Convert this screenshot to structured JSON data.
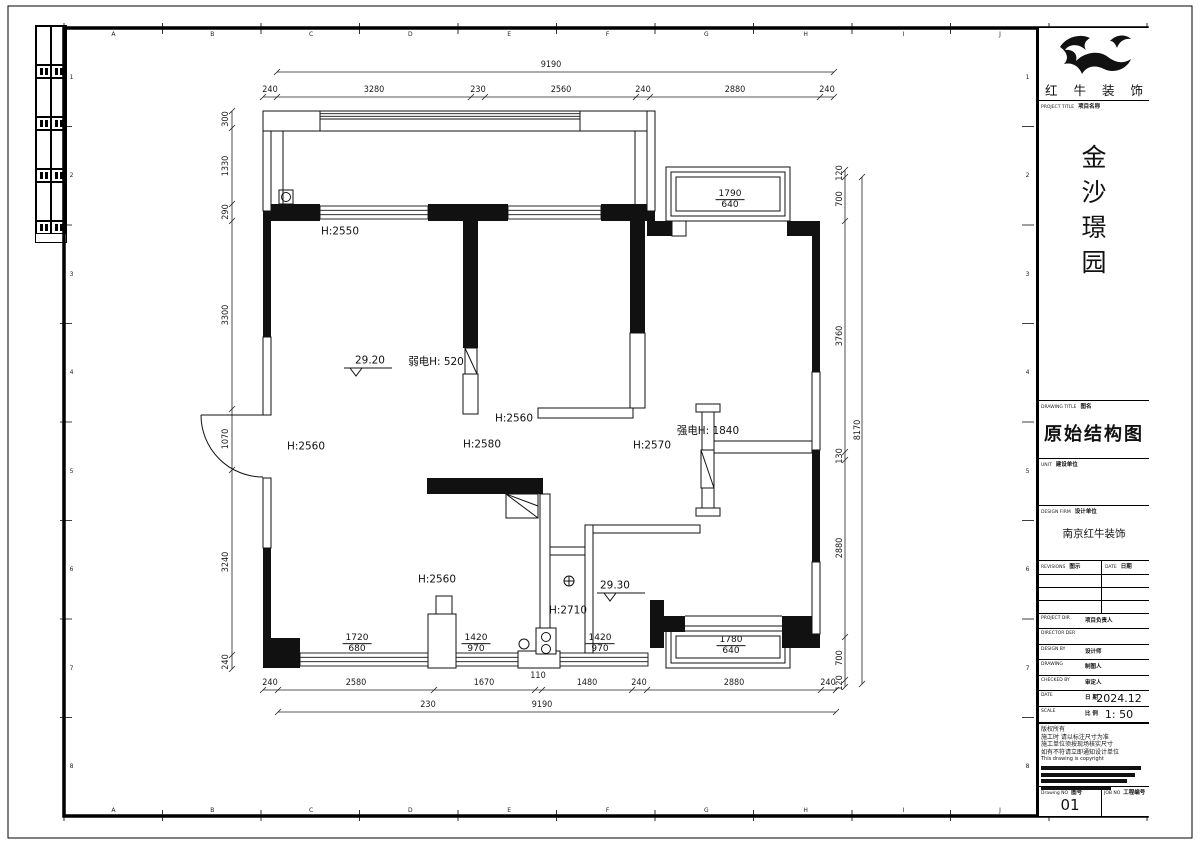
{
  "sheet": {
    "ruler_letters": [
      "A",
      "B",
      "C",
      "D",
      "E",
      "F",
      "G",
      "H",
      "I",
      "J",
      "K"
    ],
    "ruler_numbers_left": [
      "1",
      "2",
      "3",
      "4",
      "5",
      "6",
      "7",
      "8"
    ],
    "ruler_numbers_right": [
      "1",
      "2",
      "3",
      "4",
      "5",
      "6",
      "7",
      "8"
    ]
  },
  "title_block": {
    "brand_name": "红 牛 装 饰",
    "project_label_en": "PROJECT TITLE",
    "project_label_zh": "项目名称",
    "project_name": "金沙璟园",
    "project_name_chars": [
      "金",
      "沙",
      "璟",
      "园"
    ],
    "drawing_title_label_en": "DRAWING TITLE",
    "drawing_title_label_zh": "图名",
    "drawing_title": "原始结构图",
    "unit_label_en": "UNIT",
    "unit_label_zh": "建设单位",
    "design_firm_label_en": "DESIGN FIRM",
    "design_firm_label_zh": "设计单位",
    "design_firm": "南京红牛装饰",
    "revisions_label_en": "REVISIONS",
    "revisions_label_zh": "图示",
    "date_label_en": "DATE",
    "date_label_zh": "日期",
    "rows": [
      {
        "en": "PROJECT DIR",
        "zh": "项目负责人",
        "value": ""
      },
      {
        "en": "DIRECTOR DER",
        "zh": "",
        "value": ""
      },
      {
        "en": "DESIGN BY",
        "zh": "设计师",
        "value": ""
      },
      {
        "en": "DRAWING",
        "zh": "制图人",
        "value": ""
      },
      {
        "en": "CHECKED BY",
        "zh": "审定人",
        "value": ""
      },
      {
        "en": "DATE",
        "zh": "日 期",
        "value": "2024.12"
      },
      {
        "en": "SCALE",
        "zh": "比 例",
        "value": "1: 50"
      }
    ],
    "notes": [
      "版权所有",
      "施工时 请以标注尺寸为准",
      "施工单位须按现场核实尺寸",
      "如有不符请立即通知设计单位",
      "This drawing is copyright"
    ],
    "drawing_no_label_en": "Drawing NO",
    "drawing_no_label_zh": "图号",
    "drawing_no": "01",
    "job_no_label_en": "JOB NO",
    "job_no_label_zh": "工程编号",
    "job_no": ""
  },
  "plan": {
    "labels": {
      "balcony_height": "H:2550",
      "weak_current": "弱电H: 520",
      "level_upper": "29.20",
      "bedroom2_height": "H:2560",
      "hall_height": "H:2580",
      "room_right_height": "H:2570",
      "strong_current": "强电H: 1840",
      "living_height_left": "H:2560",
      "living_height_bottom": "H:2560",
      "bath_height": "H:2710",
      "level_lower": "29.30"
    },
    "windows": {
      "bay_top": {
        "w": "1790",
        "h": "640"
      },
      "bay_bottom": {
        "w": "1780",
        "h": "640"
      },
      "win_left": {
        "w": "1720",
        "h": "680"
      },
      "win_mid": {
        "w": "1420",
        "h": "970"
      },
      "win_right": {
        "w": "1420",
        "h": "970"
      }
    },
    "dims": {
      "top_overall": "9190",
      "top": [
        "240",
        "3280",
        "230",
        "2560",
        "240",
        "2880",
        "240"
      ],
      "left": [
        "300",
        "1330",
        "290",
        "3300",
        "1070",
        "3240",
        "240"
      ],
      "right": [
        "120",
        "700",
        "3760",
        "130",
        "2880",
        "700",
        "120"
      ],
      "right_overall": "8170",
      "bottom": [
        "240",
        "2580",
        "1670",
        "110",
        "1480",
        "240",
        "2880",
        "240"
      ],
      "bottom_overall_prefix": "230",
      "bottom_overall": "9190"
    }
  }
}
